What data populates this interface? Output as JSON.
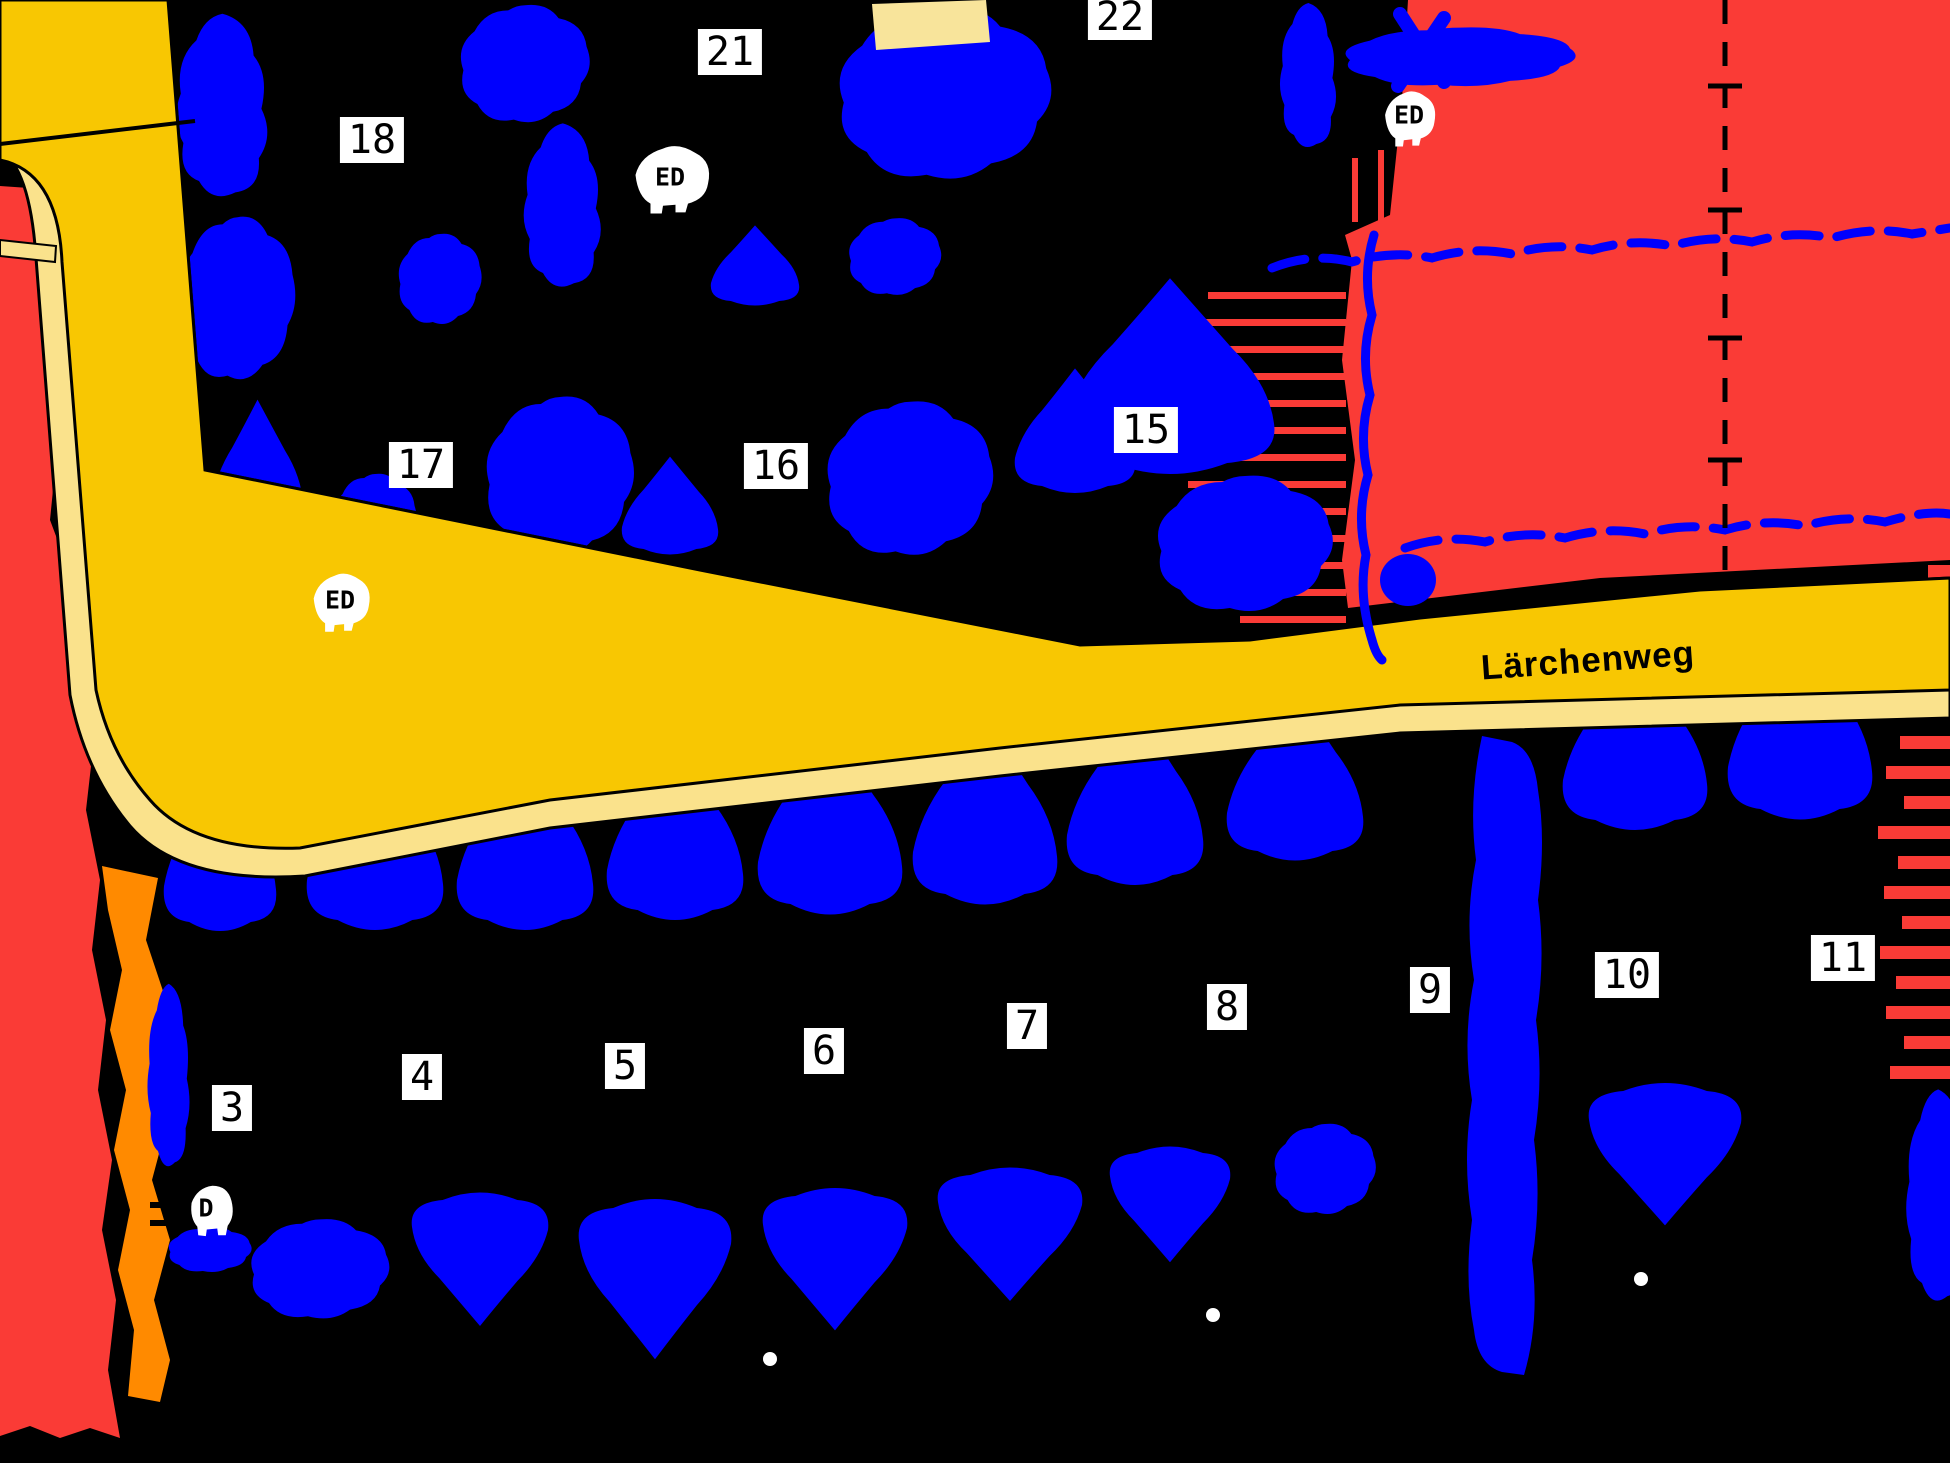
{
  "map": {
    "type": "development-plan-map",
    "street": {
      "label": "Lärchenweg"
    },
    "plots": [
      {
        "label": "3"
      },
      {
        "label": "4"
      },
      {
        "label": "5"
      },
      {
        "label": "6"
      },
      {
        "label": "7"
      },
      {
        "label": "8"
      },
      {
        "label": "9"
      },
      {
        "label": "10"
      },
      {
        "label": "11"
      },
      {
        "label": "15"
      },
      {
        "label": "16"
      },
      {
        "label": "17"
      },
      {
        "label": "18"
      },
      {
        "label": "21"
      },
      {
        "label": "22"
      }
    ],
    "markers": [
      {
        "label": "ED"
      },
      {
        "label": "ED"
      },
      {
        "label": "ED"
      },
      {
        "label": "D"
      }
    ],
    "colors": {
      "background": "#000000",
      "road_fill": "#F8C702",
      "road_edge_fill": "#FAE28C",
      "vegetation_fill": "#0000FE",
      "red_area_fill": "#FA3B36",
      "orange_strip_fill": "#FF8A00",
      "building_fill": "#F8E49B",
      "label_bg": "#FFFFFF",
      "label_text": "#000000"
    }
  }
}
